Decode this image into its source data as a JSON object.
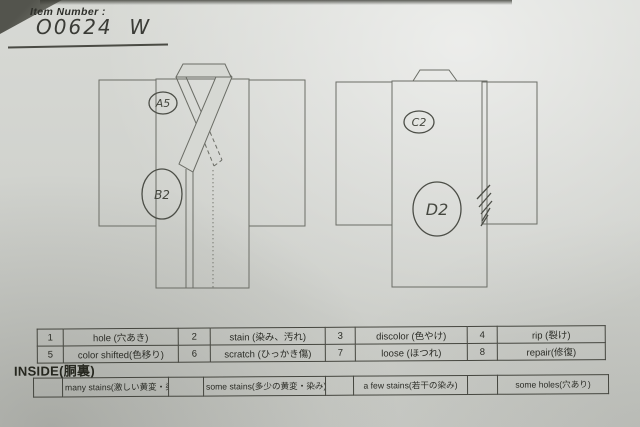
{
  "header": {
    "label": "Item Number :",
    "value": "O0624  W"
  },
  "front_view": {
    "annotations": {
      "a": "A5",
      "b": "B2"
    }
  },
  "back_view": {
    "annotations": {
      "c": "C2",
      "d": "D2"
    }
  },
  "legend": {
    "row1": [
      "1",
      "hole (穴あき)",
      "2",
      "stain (染み、汚れ)",
      "3",
      "discolor (色やけ)",
      "4",
      "rip (裂け)"
    ],
    "row2": [
      "5",
      "color shifted(色移り)",
      "6",
      "scratch (ひっかき傷)",
      "7",
      "loose (ほつれ)",
      "8",
      "repair(修復)"
    ]
  },
  "inside": {
    "title": "INSIDE(胴裏)",
    "options": [
      "many stains(激しい黄変・染み)",
      "some stains(多少の黄変・染み)",
      "a few stains(若干の染み)",
      "some holes(穴あり)"
    ]
  },
  "colors": {
    "paper": "#d3d5d0",
    "surface_dark": "#53544d",
    "diagram_line": "#6b6d66",
    "ink": "#3a3b36",
    "table_line": "#45463f"
  }
}
